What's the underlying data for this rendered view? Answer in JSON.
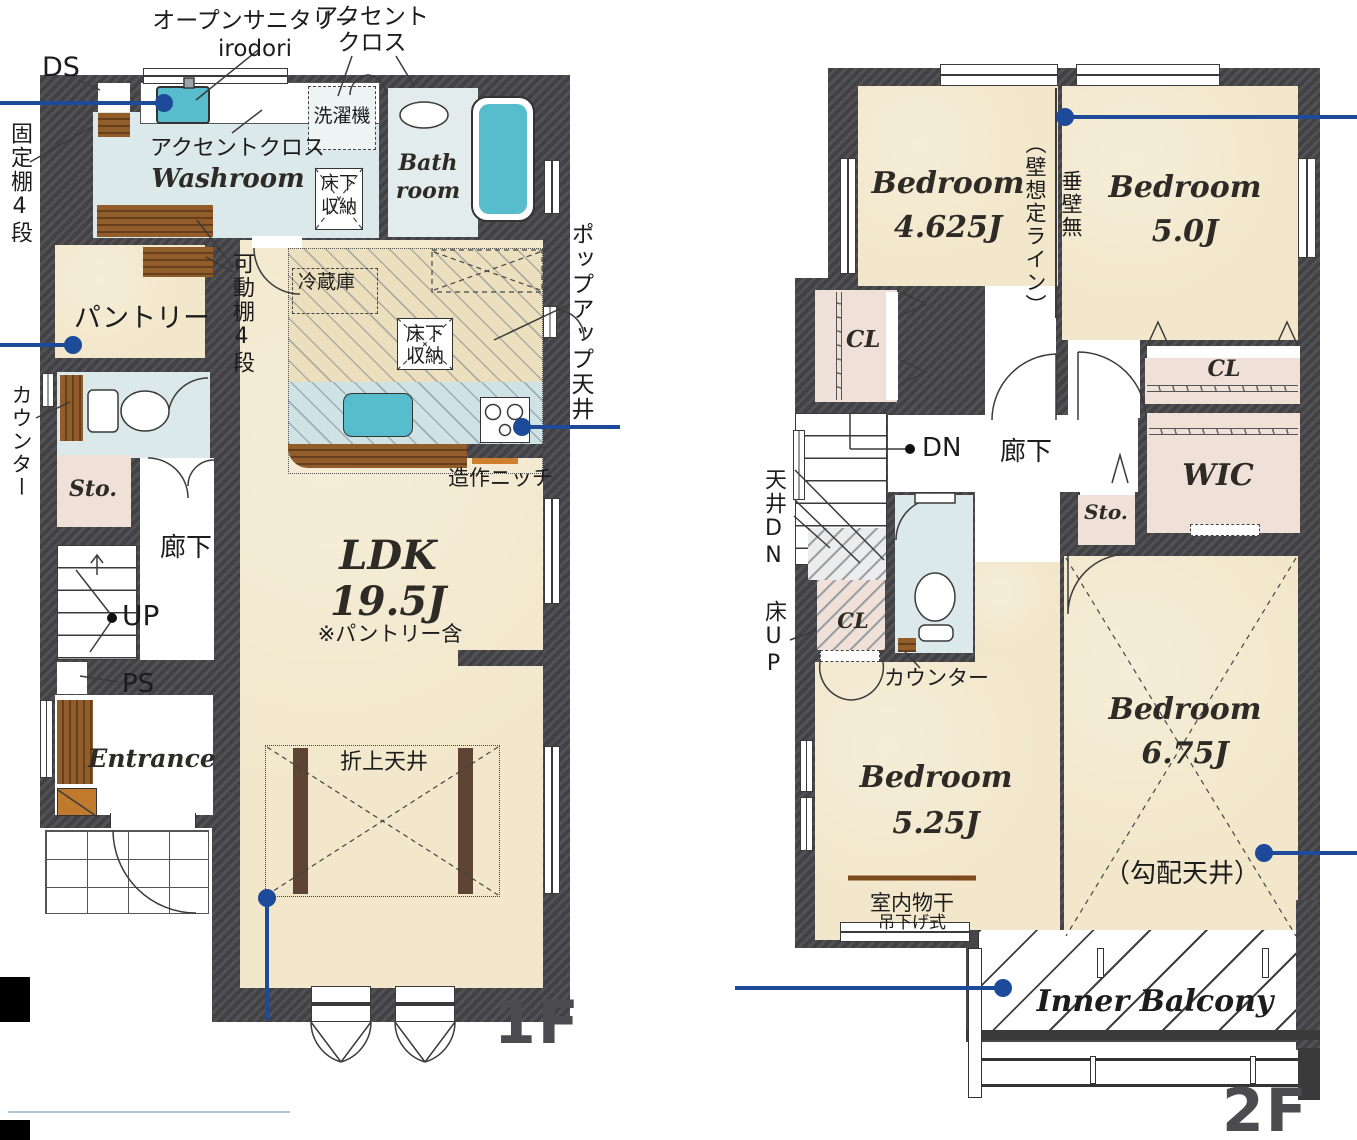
{
  "meta": {
    "type": "floor-plan",
    "floors": [
      "1F",
      "2F"
    ]
  },
  "colors": {
    "wall": "#47474b",
    "floor_beige": "#f2e7cb",
    "floor_water": "#dce9ea",
    "floor_pink": "#efe1d8",
    "accent_teal": "#57bccb",
    "wood": "#925d2b",
    "callout_blue": "#1e4b99",
    "floor_label_gray": "#4c4c50"
  },
  "f1": {
    "floor": "1F",
    "ds": "DS",
    "os1": "オープンサニタリー",
    "os2": "irodori",
    "ac1": "アクセント",
    "ac2": "クロス",
    "acw": "アクセントクロス",
    "fixed": "固定棚4段",
    "movable": "可動棚4段",
    "washroom": "Washroom",
    "washer": "洗濯機",
    "bath1": "Bath",
    "bath2": "room",
    "ufsa1": "床下",
    "ufsa2": "収納",
    "ufsb1": "床下",
    "ufsb2": "収納",
    "pantry": "パントリー",
    "fridge": "冷蔵庫",
    "popup": "ポップアップ天井",
    "counter": "カウンター",
    "sto": "Sto.",
    "hall": "廊下",
    "up": "UP",
    "ps": "PS",
    "entrance": "Entrance",
    "ldk": "LDK",
    "ldk_size": "19.5J",
    "ldk_note": "※パントリー含",
    "niche": "造作ニッチ",
    "coffered": "折上天井"
  },
  "f2": {
    "floor": "2F",
    "b1": "Bedroom",
    "b1s": "4.625J",
    "b2": "Bedroom",
    "b2s": "5.0J",
    "b3": "Bedroom",
    "b3s": "5.25J",
    "b4": "Bedroom",
    "b4s": "6.75J",
    "wall_line": "（壁想定ライン）",
    "tare": "垂壁無",
    "cl1": "CL",
    "cl2": "CL",
    "cl3": "CL",
    "wic": "WIC",
    "sto": "Sto.",
    "hall": "廊下",
    "dn": "DN",
    "tenjo": "天井DN",
    "yuka": "床UP",
    "counter": "カウンター",
    "drying": "室内物干",
    "hanging": "吊下げ式",
    "slope": "（勾配天井）",
    "balcony": "Inner Balcony"
  }
}
